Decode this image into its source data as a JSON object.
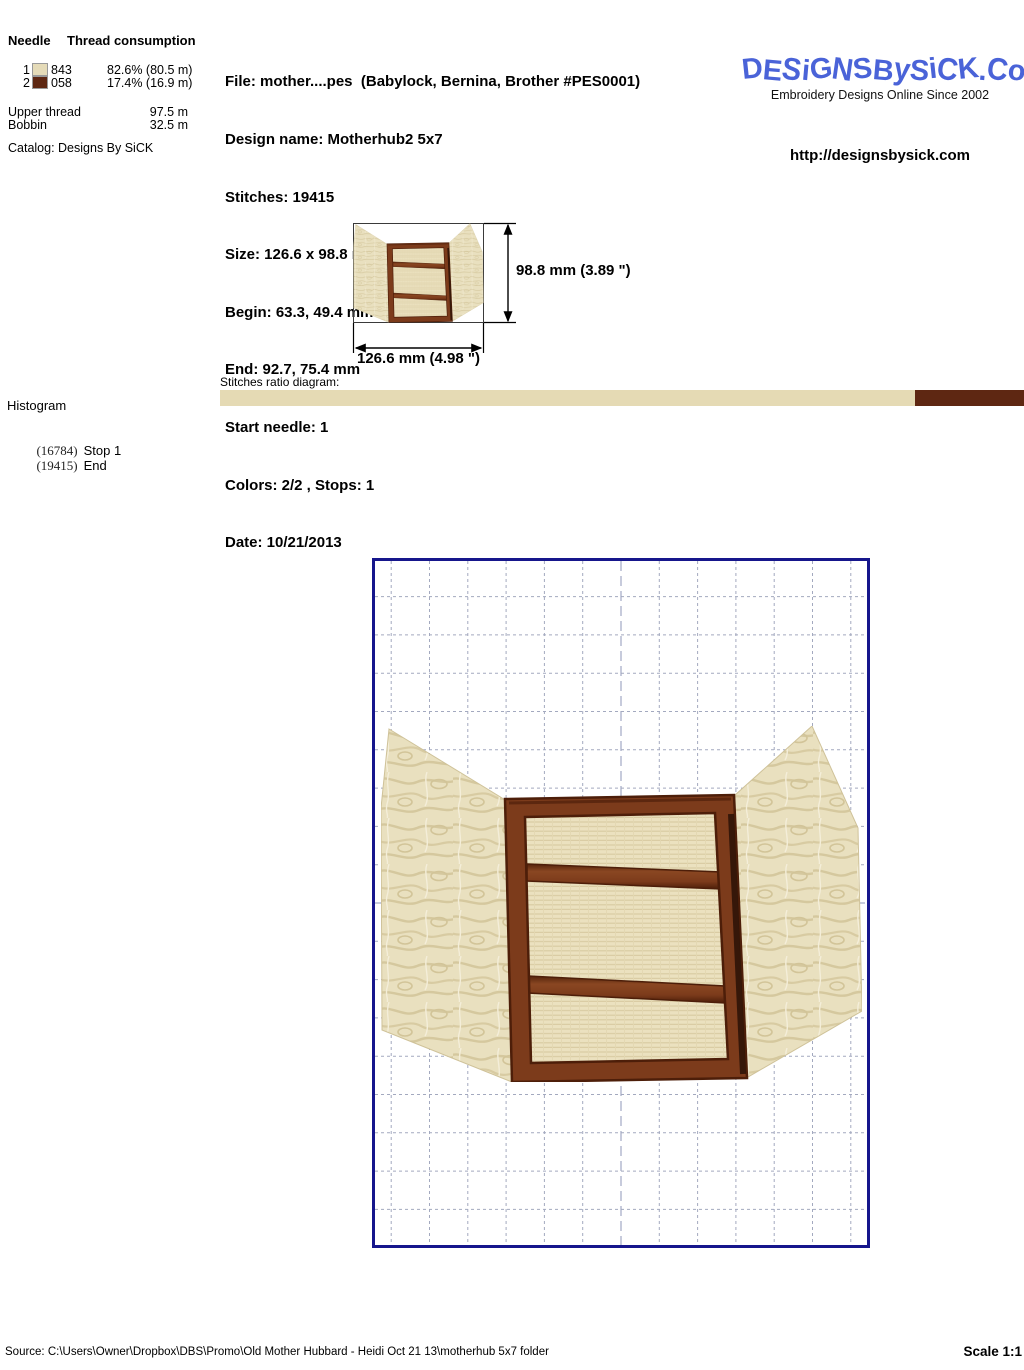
{
  "header": {
    "needle_table": {
      "col_needle": "Needle",
      "col_consumption": "Thread consumption",
      "rows": [
        {
          "needle": "1",
          "color": "#e5dbb8",
          "code": "843",
          "consumption": "82.6% (80.5 m)"
        },
        {
          "needle": "2",
          "color": "#5e2712",
          "code": "058",
          "consumption": "17.4% (16.9 m)"
        }
      ],
      "upper_thread_label": "Upper thread",
      "upper_thread_value": "97.5 m",
      "bobbin_label": "Bobbin",
      "bobbin_value": "32.5 m",
      "catalog": "Catalog: Designs By SiCK"
    },
    "file_info": {
      "lines": [
        "File: mother....pes  (Babylock, Bernina, Brother #PES0001)",
        "Design name: Motherhub2 5x7",
        "Stitches: 19415",
        "Size: 126.6 x 98.8 mm (4.98 x 3.89 \")",
        "Begin: 63.3, 49.4 mm",
        "End: 92.7, 75.4 mm",
        "Start needle: 1",
        "Colors: 2/2 , Stops: 1",
        "Date: 10/21/2013"
      ]
    },
    "brand": {
      "logo": "DESiGNSBySiCK.CoM",
      "logo_color": "#4a63d8",
      "tagline": "Embroidery Designs Online Since 2002",
      "url": "http://designsbysick.com"
    }
  },
  "thumbnail": {
    "height_label": "98.8 mm (3.89 \")",
    "width_label": "126.6 mm (4.98 \")"
  },
  "stitch_ratio": {
    "label": "Stitches ratio diagram:",
    "segments": [
      {
        "color": "#e5dab4",
        "percent": 86.45
      },
      {
        "color": "#5e2712",
        "percent": 13.55
      }
    ]
  },
  "histogram": {
    "title": "Histogram",
    "entries": [
      {
        "count": "(16784)",
        "label": "Stop 1"
      },
      {
        "count": "(19415)",
        "label": "End"
      }
    ]
  },
  "design_colors": {
    "fabric_cream": "#e9e0bf",
    "grain": "#d5c89e",
    "fill_cream": "#ebe1bf",
    "frame_brown": "#7c3b1b",
    "frame_dark": "#4d1e09",
    "shadow": "#2a1206"
  },
  "footer": {
    "source": "Source: C:\\Users\\Owner\\Dropbox\\DBS\\Promo\\Old Mother Hubbard - Heidi Oct 21 13\\motherhub 5x7 folder",
    "scale": "Scale 1:1"
  }
}
